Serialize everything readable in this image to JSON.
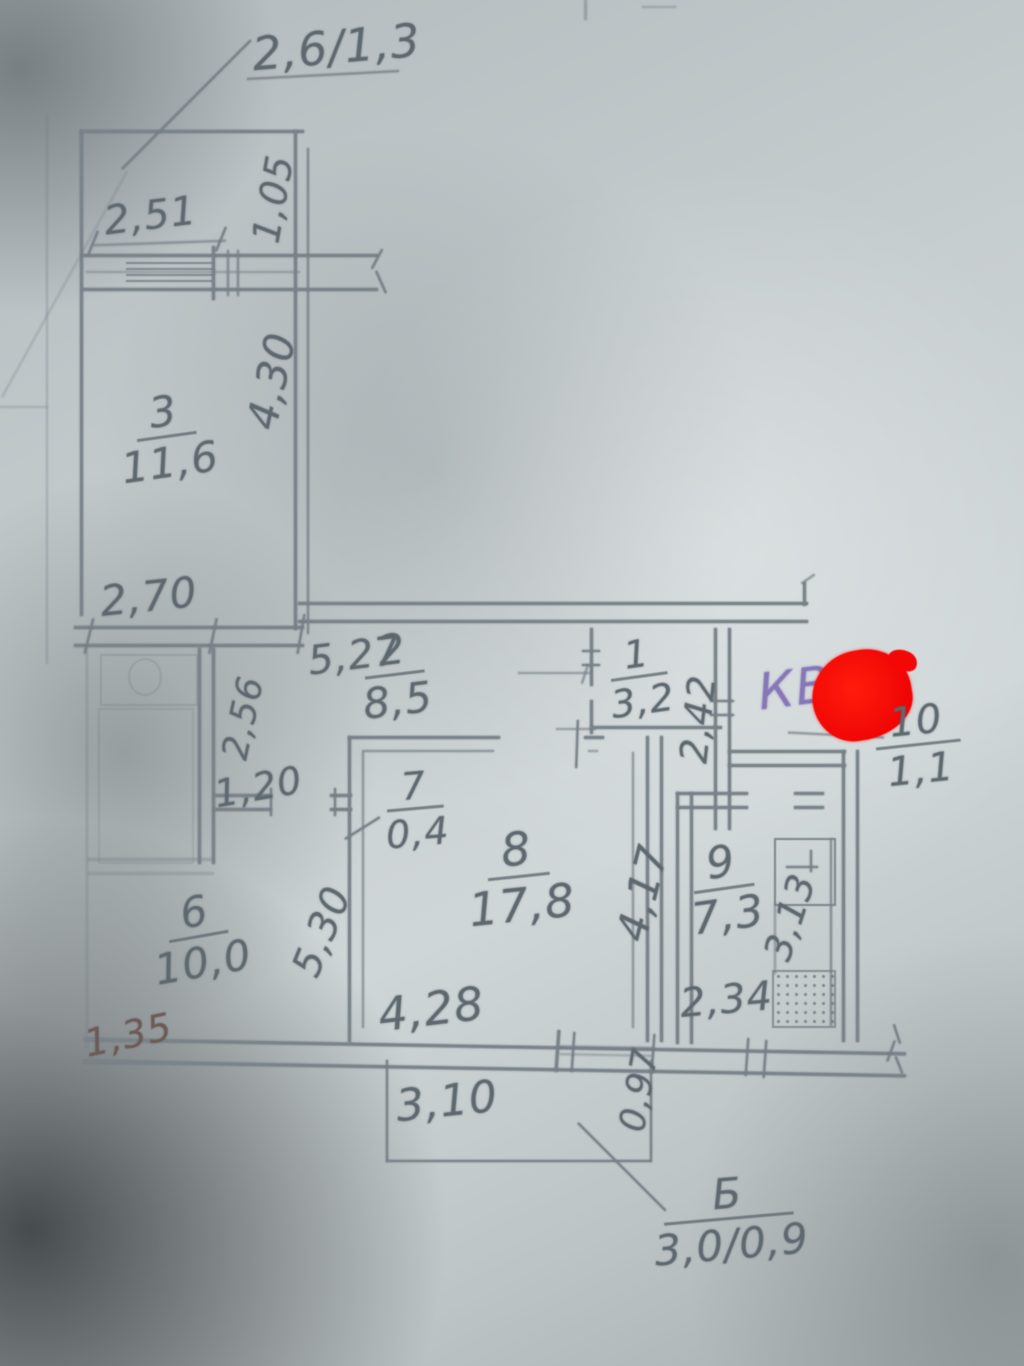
{
  "plan": {
    "kind": "hand-drawn apartment floor plan photo",
    "pencil_color": "#68727a",
    "apartment_mark": {
      "prefix": "КВ.",
      "ink_color": "#8678b6",
      "redaction_color": "#f30707"
    }
  },
  "rooms": [
    {
      "id": "3",
      "area": "11,6"
    },
    {
      "id": "2",
      "area": "8,5"
    },
    {
      "id": "1",
      "area": "3,2"
    },
    {
      "id": "10",
      "area": "1,1"
    },
    {
      "id": "7",
      "area": "0,4"
    },
    {
      "id": "8",
      "area": "17,8"
    },
    {
      "id": "9",
      "area": "7,3"
    },
    {
      "id": "6",
      "area": "10,0"
    },
    {
      "id": "Б",
      "area": "3,0/0,9"
    }
  ],
  "dimensions": {
    "balcony_top": "2,6/1,3",
    "d_2_51": "2,51",
    "d_1_05": "1,05",
    "d_4_30": "4,30",
    "d_2_70": "2,70",
    "d_5_27": "5,27",
    "d_2_56": "2,56",
    "d_1_20": "1,20",
    "d_2_42": "2,42",
    "d_4_17": "4,17",
    "d_3_13": "3,13",
    "d_5_30": "5,30",
    "d_1_35": "1,35",
    "d_4_28": "4,28",
    "d_2_34": "2,34",
    "d_3_10": "3,10",
    "d_0_97": "0,97"
  }
}
